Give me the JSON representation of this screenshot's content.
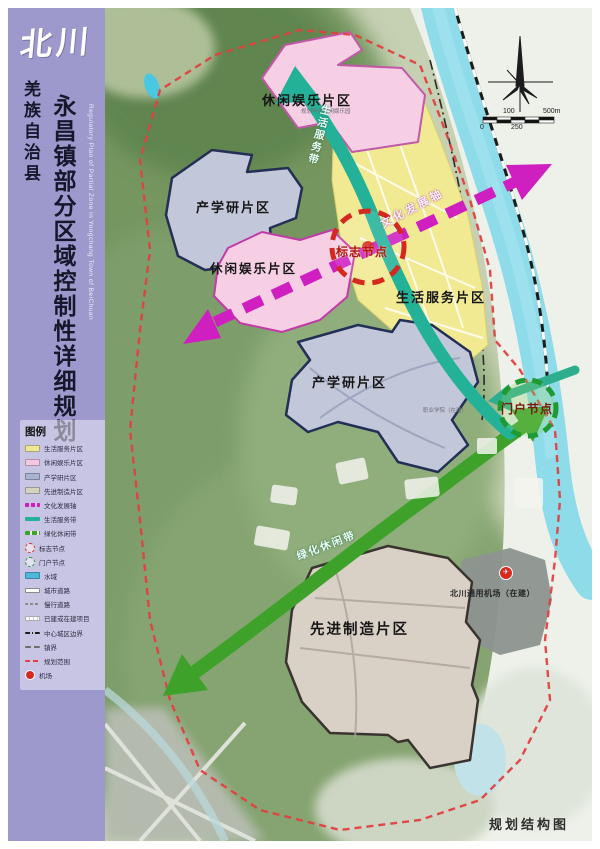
{
  "sidebar": {
    "logo": "北川",
    "county": "羌族自治县",
    "title": "永昌镇部分区域控制性详细规划",
    "title_en": "Regulatory Plan of Partial Zone in Yongchang Town of BeiChuan"
  },
  "legend": {
    "header": "图例",
    "items": [
      {
        "label": "生活服务片区",
        "swatch": "area-life"
      },
      {
        "label": "休闲娱乐片区",
        "swatch": "area-leisure"
      },
      {
        "label": "产学研片区",
        "swatch": "area-research"
      },
      {
        "label": "先进制造片区",
        "swatch": "area-mfg"
      },
      {
        "label": "文化发展轴",
        "swatch": "axis-culture"
      },
      {
        "label": "生活服务带",
        "swatch": "belt-life"
      },
      {
        "label": "绿化休闲带",
        "swatch": "belt-green"
      },
      {
        "label": "标志节点",
        "swatch": "node-landmark"
      },
      {
        "label": "门户节点",
        "swatch": "node-gateway"
      },
      {
        "label": "水域",
        "swatch": "water"
      },
      {
        "label": "城市道路",
        "swatch": "road-city"
      },
      {
        "label": "慢行道路",
        "swatch": "road-slow"
      },
      {
        "label": "已建或在建项目",
        "swatch": "built"
      },
      {
        "label": "中心城区边界",
        "swatch": "boundary-center"
      },
      {
        "label": "镇界",
        "swatch": "boundary-town"
      },
      {
        "label": "规划范围",
        "swatch": "plan-scope"
      },
      {
        "label": "机场",
        "swatch": "airport"
      }
    ]
  },
  "map": {
    "zones": {
      "leisure_top": "休闲娱乐片区",
      "leisure_top_sub": "规划特色休闲娱乐园",
      "research_left": "产学研片区",
      "leisure_mid": "休闲娱乐片区",
      "life": "生活服务片区",
      "research_mid": "产学研片区",
      "manufacturing": "先进制造片区"
    },
    "axes": {
      "culture": "文化发展轴",
      "life_belt": "生活服务带",
      "green_belt": "绿化休闲带"
    },
    "nodes": {
      "landmark": "标志节点",
      "gateway": "门户节点"
    },
    "labels": {
      "airport": "北川通用机场（在建）",
      "college": "职业学院（在建）",
      "caption": "规划结构图"
    },
    "airport_icon": "✈",
    "scalebar": {
      "top_left": "100",
      "top_right": "500m",
      "bottom_left": "0",
      "bottom_mid": "250"
    }
  },
  "colors": {
    "sidebar": "#9d99cd",
    "zone_life": "#f2ea92",
    "zone_leisure": "#f6cfe4",
    "zone_research": "#c2c8da",
    "zone_manufacturing": "#d9d0c6",
    "water": "#8edbea",
    "axis_culture": "#cf1fc0",
    "belt_life": "#23b298",
    "belt_green": "#3ea22a",
    "node_landmark": "#d5281e",
    "node_gateway": "#1f9a33",
    "plan_boundary": "#e04040"
  }
}
